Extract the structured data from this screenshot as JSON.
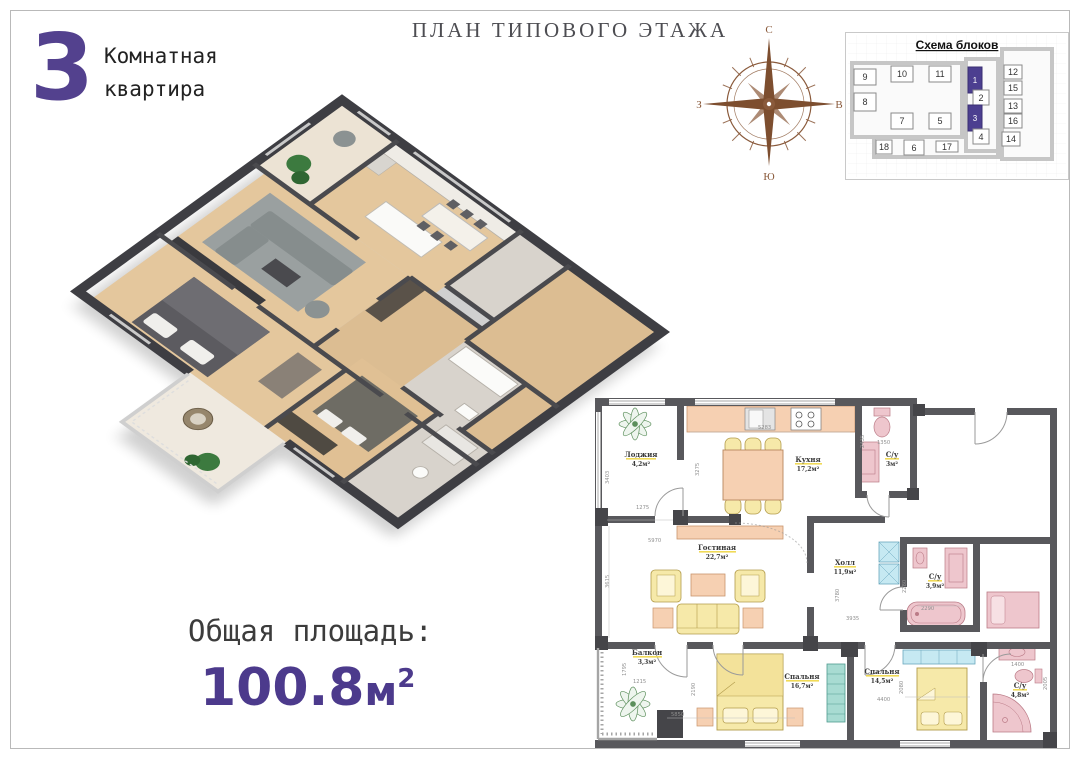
{
  "theme": {
    "accent_purple": "#53418e",
    "block_highlight": "#4c3f90",
    "compass_brown": "#8a5a3b",
    "wall_dark": "#58585c",
    "furniture_yellow": "#f6e9a9",
    "furniture_peach": "#f6d0b2",
    "fixture_pink": "#eec6cd",
    "cabinet_blue": "#c6e9f2"
  },
  "header": {
    "title": "ПЛАН ТИПОВОГО ЭТАЖА"
  },
  "apartment": {
    "number": "3",
    "line1": "Комнатная",
    "line2": "квартира"
  },
  "total_area": {
    "label": "Общая площадь:",
    "value": "100.8",
    "unit": "м",
    "sup": "2"
  },
  "compass": {
    "north": "С",
    "east": "В",
    "south": "Ю",
    "west": "З"
  },
  "block_scheme": {
    "title": "Схема блоков",
    "blocks": [
      {
        "num": "9"
      },
      {
        "num": "10"
      },
      {
        "num": "11"
      },
      {
        "num": "1",
        "highlighted": true
      },
      {
        "num": "12"
      },
      {
        "num": "8"
      },
      {
        "num": "2"
      },
      {
        "num": "15"
      },
      {
        "num": "13"
      },
      {
        "num": "7"
      },
      {
        "num": "5"
      },
      {
        "num": "3",
        "highlighted": true
      },
      {
        "num": "16"
      },
      {
        "num": "4"
      },
      {
        "num": "14"
      },
      {
        "num": "18"
      },
      {
        "num": "6"
      },
      {
        "num": "17"
      }
    ]
  },
  "plan2d": {
    "rooms": [
      {
        "name": "Лоджия",
        "area": "4,2м²"
      },
      {
        "name": "Кухня",
        "area": "17,2м²"
      },
      {
        "name": "С/у",
        "area": "3м²"
      },
      {
        "name": "Гостиная",
        "area": "22,7м²"
      },
      {
        "name": "Холл",
        "area": "11,9м²"
      },
      {
        "name": "С/у",
        "area": "3,9м²"
      },
      {
        "name": "Балкон",
        "area": "3,3м²"
      },
      {
        "name": "Спальня",
        "area": "16,7м²"
      },
      {
        "name": "Спальня",
        "area": "14,5м²"
      },
      {
        "name": "С/у",
        "area": "4,8м²"
      }
    ],
    "dimensions": [
      "5283",
      "3275",
      "1275",
      "3403",
      "5970",
      "3615",
      "2435",
      "1350",
      "2290",
      "2280",
      "3780",
      "3935",
      "1215",
      "1795",
      "5850",
      "2190",
      "4400",
      "2080",
      "1400",
      "2005"
    ]
  }
}
